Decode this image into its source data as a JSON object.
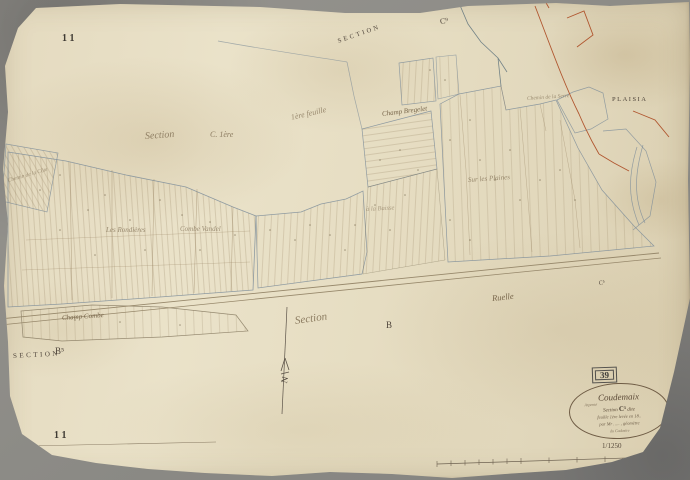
{
  "map": {
    "plate_number_top": "11",
    "plate_number_bottom": "11",
    "sheet_stamp": "39",
    "scale_label": "1/1250",
    "north_letter": "N",
    "printed": {
      "section_top": "SECTION",
      "code_c9": "C⁹",
      "commune_plaisia": "PLAISIA",
      "section_bottom": "SECTION",
      "code_b5": "B⁵",
      "letter_b": "B",
      "code_c5": "C⁵"
    },
    "handwritten": [
      {
        "text": "Section"
      },
      {
        "text": "C. 1ère"
      },
      {
        "text": "1ère feuille"
      },
      {
        "text": "Champ Bregelet"
      },
      {
        "text": "Sur les Plaines"
      },
      {
        "text": "Les Rondières"
      },
      {
        "text": "Combe Vandel"
      },
      {
        "text": "à la Baisse"
      },
      {
        "text": "Ruelle"
      },
      {
        "text": "Section"
      },
      {
        "text": "Champ Combe"
      },
      {
        "text": "Chemin de la Côte"
      },
      {
        "text": "Chemin de la Serre"
      }
    ],
    "cartouche": {
      "title": "Coudemaix",
      "note_left": "Arpenté",
      "section_line_pre": "Section",
      "section_code": "C¹",
      "section_line_post": "dite",
      "feuille_line": "feuille 1ère levée en 18..",
      "surveyor_line": "par Mr ….. , géomètre",
      "footer_line": "du Cadastre"
    }
  }
}
